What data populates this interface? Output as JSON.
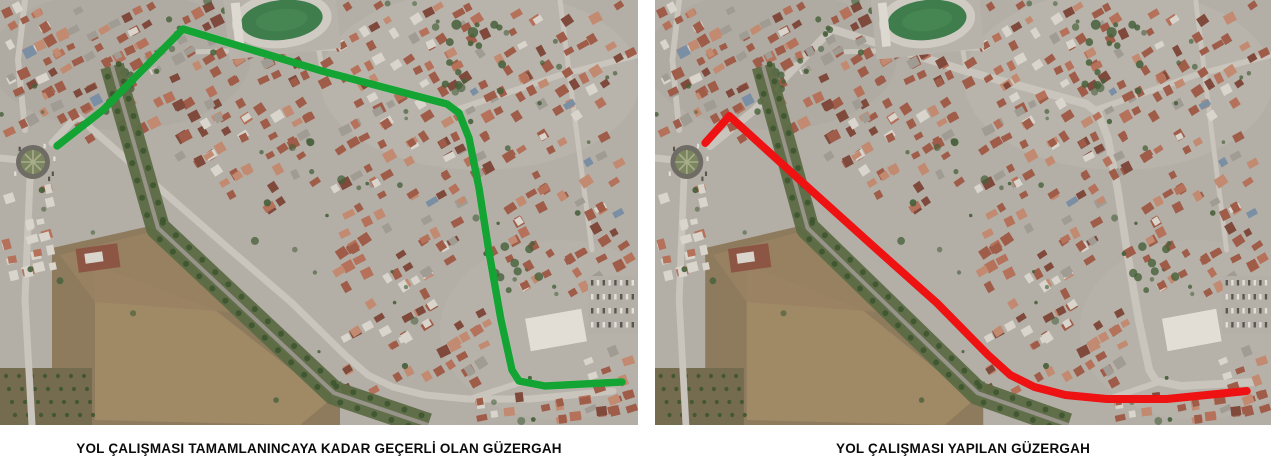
{
  "panels": {
    "left": {
      "caption": "YOL ÇALIŞMASI TAMAMLANINCAYA KADAR GEÇERLİ OLAN GÜZERGAH",
      "route_color": "#14a433",
      "route_width": 7.5,
      "route_points": [
        [
          57,
          146
        ],
        [
          103,
          110
        ],
        [
          183,
          29
        ],
        [
          322,
          71
        ],
        [
          447,
          104
        ],
        [
          459,
          113
        ],
        [
          469,
          138
        ],
        [
          479,
          188
        ],
        [
          489,
          252
        ],
        [
          501,
          320
        ],
        [
          512,
          370
        ],
        [
          519,
          381
        ],
        [
          545,
          386
        ],
        [
          622,
          382
        ]
      ]
    },
    "right": {
      "caption": "YOL ÇALIŞMASI YAPILAN GÜZERGAH",
      "route_color": "#ee1212",
      "route_width": 8,
      "route_points": [
        [
          52,
          143
        ],
        [
          77,
          116
        ],
        [
          150,
          180
        ],
        [
          227,
          247
        ],
        [
          292,
          303
        ],
        [
          345,
          355
        ],
        [
          368,
          375
        ],
        [
          393,
          387
        ],
        [
          425,
          395
        ],
        [
          468,
          399
        ],
        [
          530,
          399
        ],
        [
          613,
          391
        ]
      ]
    }
  },
  "map_palette": {
    "ground": "#b3afa7",
    "road": "#c9c5bd",
    "roof": "#9f5c48",
    "roof_light": "#b5715a",
    "roof_pale": "#c28a70",
    "roof_dark": "#7f4a3c",
    "roof_blue": "#7b8fa4",
    "building_white": "#d9d5cd",
    "building_gray": "#a09c94",
    "trees": "#46603a",
    "boulevard": "#5c6b44",
    "boulevard_dark": "#3e5530",
    "field": "#8e7b5e",
    "field_light": "#a38c66",
    "orchard": "#756b4f",
    "stadium_field": "#3f7d4c",
    "stadium_track": "#cfcbc3",
    "roundabout_island": "#7b8560",
    "asphalt": "#6f6b65",
    "parking": "#b4b0a8",
    "car_light": "#e3e0da",
    "car_dark": "#59564f"
  }
}
